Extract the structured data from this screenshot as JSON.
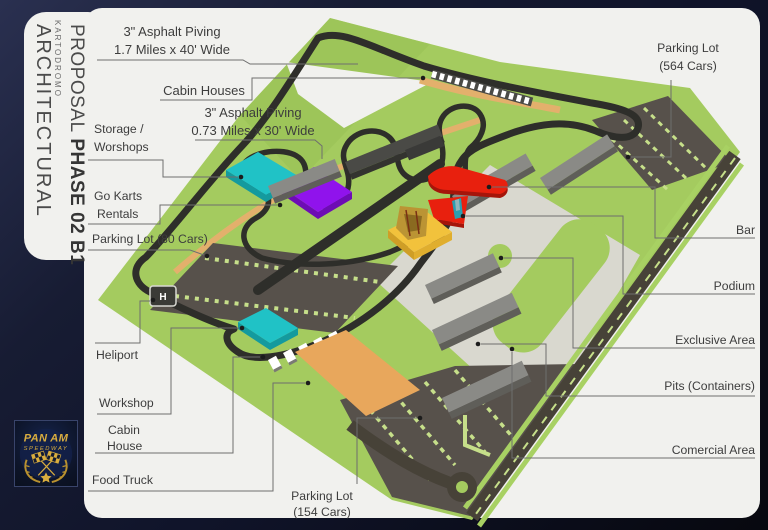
{
  "sidebar": {
    "small": "KARTODROMO",
    "line1": "ARCHITECTURAL",
    "line2": "PROPOSAL",
    "line2_bold": "PHASE 02 B1"
  },
  "logo": {
    "line1": "PAN AM",
    "line2": "SPEEDWAY"
  },
  "callouts": {
    "asphalt17_l1": "3\" Asphalt Piving",
    "asphalt17_l2": "1.7 Miles x 40' Wide",
    "cabin_houses": "Cabin Houses",
    "asphalt073_l1": "3\" Asphalt Piving",
    "asphalt073_l2": "0.73 Miles x 30' Wide",
    "storage_l1": "Storage /",
    "storage_l2": "Worshops",
    "gokarts_l1": "Go Karts",
    "gokarts_l2": "Rentals",
    "parking80": "Parking Lot (80 Cars)",
    "heliport": "Heliport",
    "workshop": "Workshop",
    "cabin_l1": "Cabin",
    "cabin_l2": "House",
    "foodtruck": "Food Truck",
    "parking154_l1": "Parking Lot",
    "parking154_l2": "(154 Cars)",
    "parking564_l1": "Parking Lot",
    "parking564_l2": "(564 Cars)",
    "bar": "Bar",
    "podium": "Podium",
    "exclusive": "Exclusive Area",
    "pits": "Pits (Containers)",
    "comercial": "Comercial Area"
  },
  "colors": {
    "card": "#f1f1ee",
    "text": "#3d3d3d",
    "line": "#6e6e6e",
    "land": "#a4cb5f",
    "landdark": "#97c153",
    "track": "#2e2e2a",
    "tan": "#e3b06c",
    "road": "#474238",
    "roadedge": "#a8d163",
    "lot": "#57514b",
    "lotstripe": "#c6df8a",
    "plaza": "#d9d8cf",
    "cyan": "#20c2c6",
    "cyandark": "#149a9e",
    "purple": "#9013ec",
    "purpledark": "#6d0cb4",
    "red": "#e8200e",
    "reddark": "#a5150a",
    "yellow": "#f2c23c",
    "yellowdark": "#cf9e26",
    "roof": "#8a8a86",
    "rooffront": "#5f5e59",
    "gold": "#d9ad3e"
  }
}
